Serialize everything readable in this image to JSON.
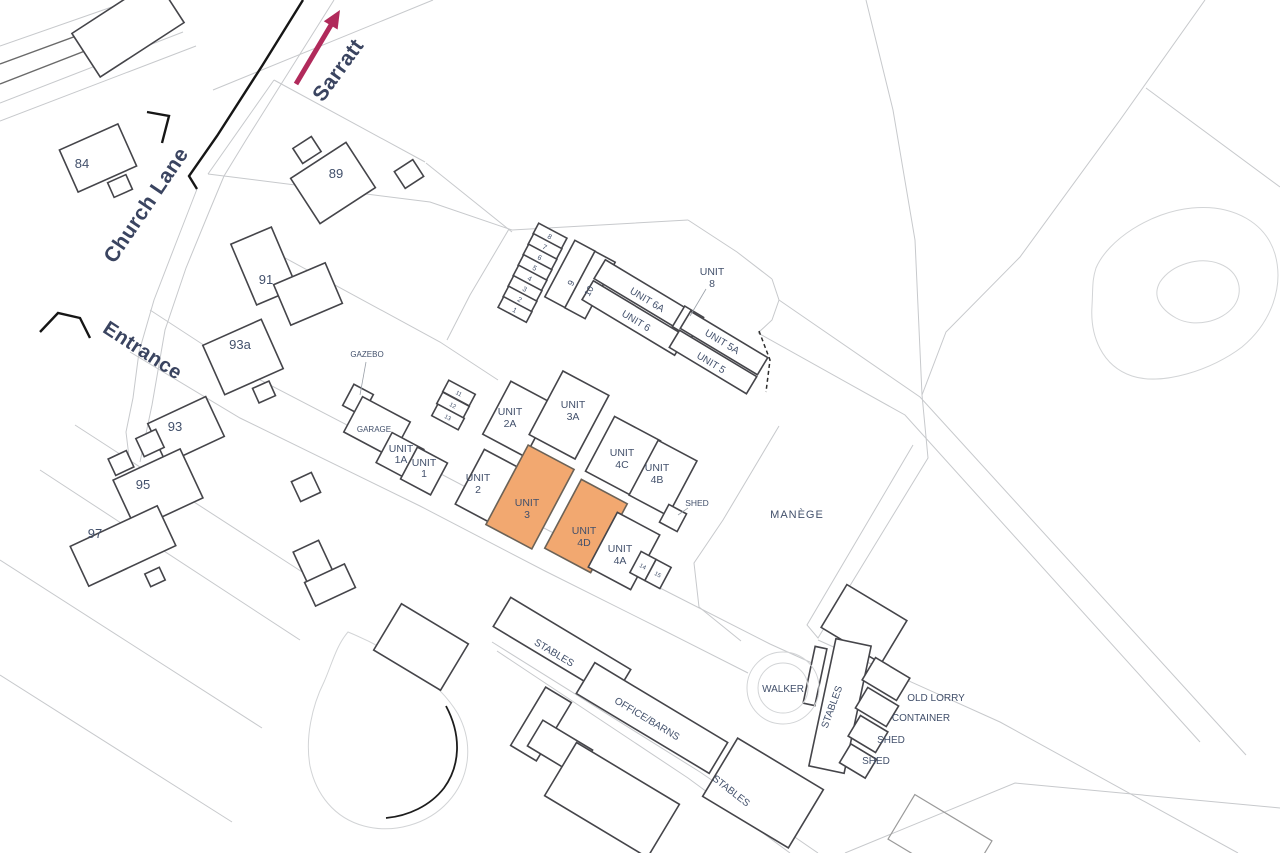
{
  "page": {
    "type": "site-location-plan",
    "background": "#ffffff"
  },
  "colors": {
    "highlight_fill": "#F2A870",
    "arrow": "#B12A5B",
    "label_text": "#42506b",
    "building_outline": "#45454a",
    "parcel_line": "#c7c9cc"
  },
  "annotations": {
    "destination_label": "Sarratt",
    "road_label": "Church Lane",
    "entrance_label": "Entrance"
  },
  "houses": {
    "h84": "84",
    "h89": "89",
    "h91": "91",
    "h93a": "93a",
    "h93": "93",
    "h95": "95",
    "h97": "97"
  },
  "site": {
    "gazebo": "GAZEBO",
    "garage": "GARAGE",
    "shed_units": "SHED",
    "manege": "MANÈGE"
  },
  "units": {
    "generic_line": "UNIT",
    "u1a": "1A",
    "u1": "1",
    "u2a": "2A",
    "u2": "2",
    "u3": "3",
    "u3a": "3A",
    "u4a": "4A",
    "u4b": "4B",
    "u4c": "4C",
    "u4d": "4D",
    "u8": "8",
    "u5": "UNIT 5",
    "u5a": "UNIT 5A",
    "u6": "UNIT 6",
    "u6a": "UNIT 6A"
  },
  "highlighted_units": [
    "UNIT 3",
    "UNIT 4D"
  ],
  "small_numbers": {
    "stack": [
      "8",
      "7",
      "6",
      "5",
      "4",
      "3",
      "2",
      "1"
    ],
    "pair": [
      "9",
      "10"
    ],
    "triple": [
      "11",
      "12",
      "13"
    ],
    "duo": [
      "14",
      "15"
    ]
  },
  "yard": {
    "walker": "WALKER",
    "stables_vertical": "STABLES",
    "old_lorry": "OLD LORRY",
    "container": "CONTAINER",
    "shed_1": "SHED",
    "shed_2": "SHED",
    "stables_strip": "STABLES",
    "office_barns": "OFFICE/BARNS",
    "stables_south": "STABLES"
  }
}
